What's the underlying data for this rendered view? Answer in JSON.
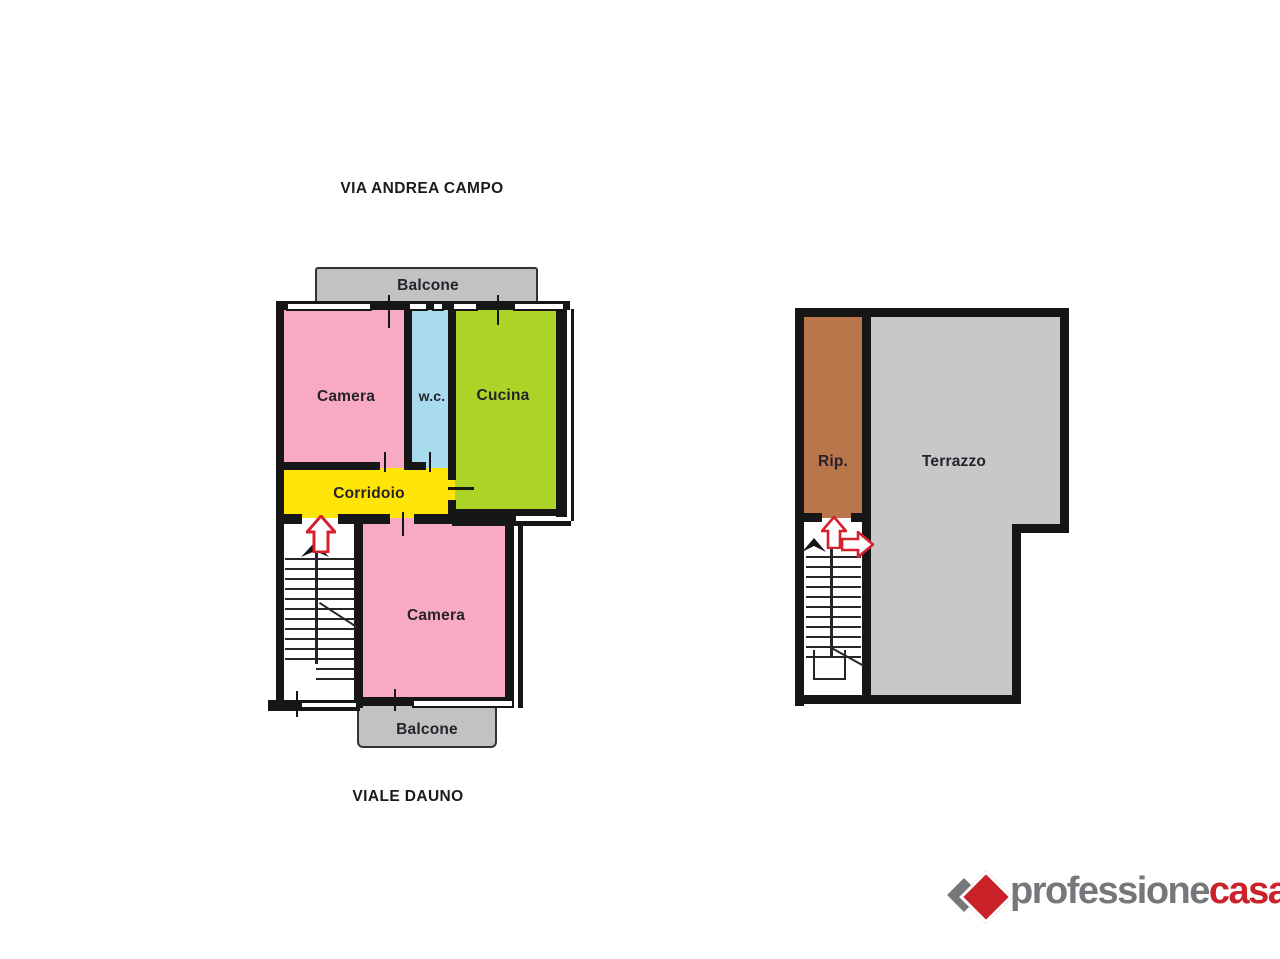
{
  "streets": {
    "top": "VIA ANDREA CAMPO",
    "bottom": "VIALE DAUNO"
  },
  "apartment_plan": {
    "balcony_top_label": "Balcone",
    "bedroom_top_label": "Camera",
    "wc_label": "w.c.",
    "kitchen_label": "Cucina",
    "hallway_label": "Corridoio",
    "bedroom_bottom_label": "Camera",
    "balcony_bottom_label": "Balcone"
  },
  "terrace_plan": {
    "storage_label": "Rip.",
    "terrace_label": "Terrazzo"
  },
  "brand": {
    "name_primary": "professione",
    "name_accent": "casa",
    "registered_mark": "®"
  },
  "colors": {
    "bedroom_fill": "#F8AAC2",
    "wc_fill": "#A9DBEE",
    "kitchen_fill": "#ABD427",
    "hallway_fill": "#FFE506",
    "balcony_fill": "#C2C2C2",
    "terrace_fill": "#C8C8C8",
    "storage_fill": "#B8764A",
    "wall": "#161616",
    "entry_arrow_red": "#D5202E",
    "brand_gray": "#76777B",
    "brand_red": "#CB2128"
  }
}
